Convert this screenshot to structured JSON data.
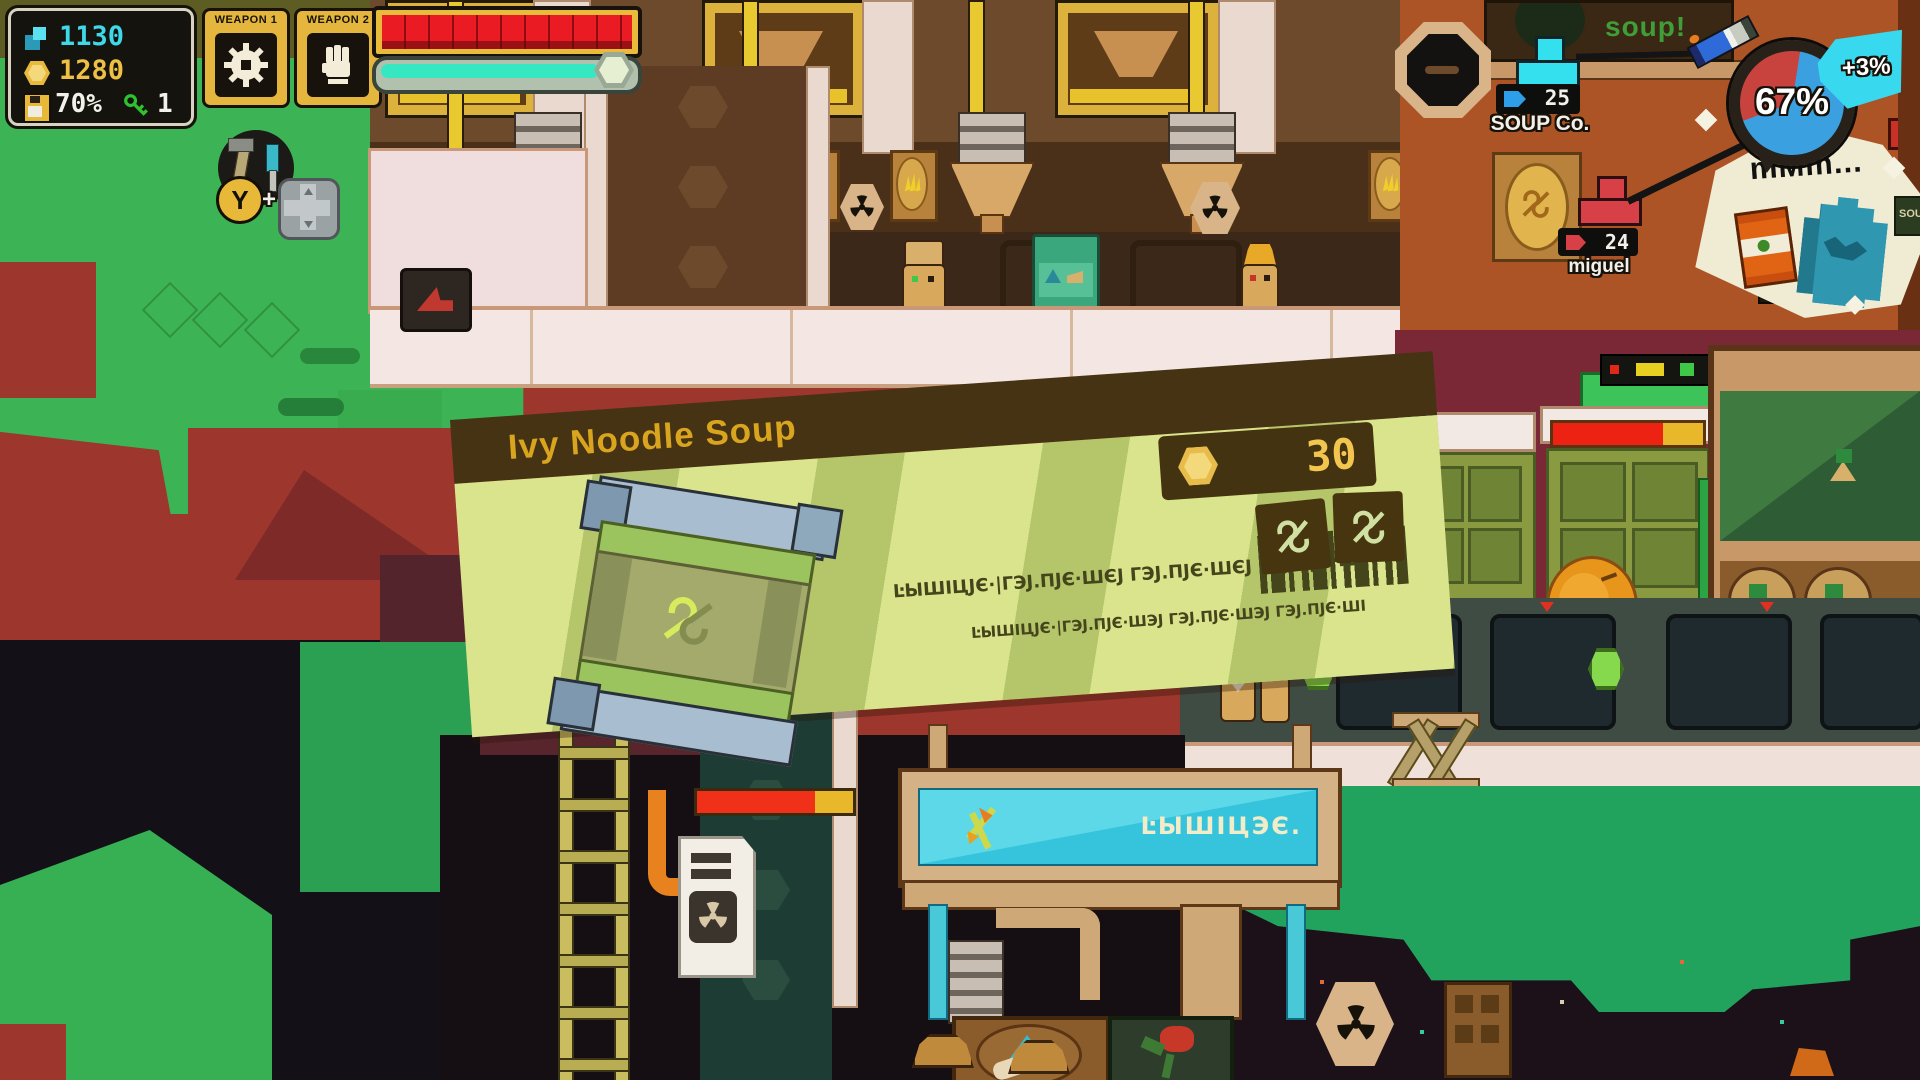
{
  "colors": {
    "accent_cyan": "#3FD8E8",
    "gold": "#E8B93C",
    "health_red": "#EA1B22",
    "stamina_teal": "#36E8C2",
    "pie_blue": "#3BA0E0",
    "pie_red": "#C8423E",
    "ticket_body_green": "#D7E388",
    "ticket_header_brown": "#463313"
  },
  "hud": {
    "crystals": "1130",
    "coins": "1280",
    "storage": "70%",
    "keys": "1",
    "weapon1_label": "WEAPON 1",
    "weapon2_label": "WEAPON 2"
  },
  "prompt": {
    "button": "Y",
    "plus": "+"
  },
  "markers": {
    "soup_co_count": "25",
    "soup_co_name": "SOUP Co.",
    "miguel_count": "24",
    "miguel_name": "miguel"
  },
  "gauge": {
    "percent": "67%",
    "delta": "+3%",
    "bubble_text": "mMm..."
  },
  "ticket": {
    "title": "Ivy Noodle Soup",
    "price": "30",
    "alien_line_1": "ĿЫШІЦЈЄ·|ГЭЈ.ПЈЄ·ШЄЈ  ГЭЈ.ПЈЄ·ШЄЈ  ГЭЈ.ПЈЄ·ШІ",
    "alien_line_2": "ĿЫШІЦЈЄ·|ГЭЈ.ПЈЄ·ШЭЈ  ГЭЈ.ПЈЄ·ШЭЈ  ГЭЈ.ПЈЄ·ШІ"
  },
  "world": {
    "soup_sign": "soup!",
    "conveyor_sign": "ĿЫШІЦЭЄ.",
    "right_edge_sign": "SOU"
  }
}
